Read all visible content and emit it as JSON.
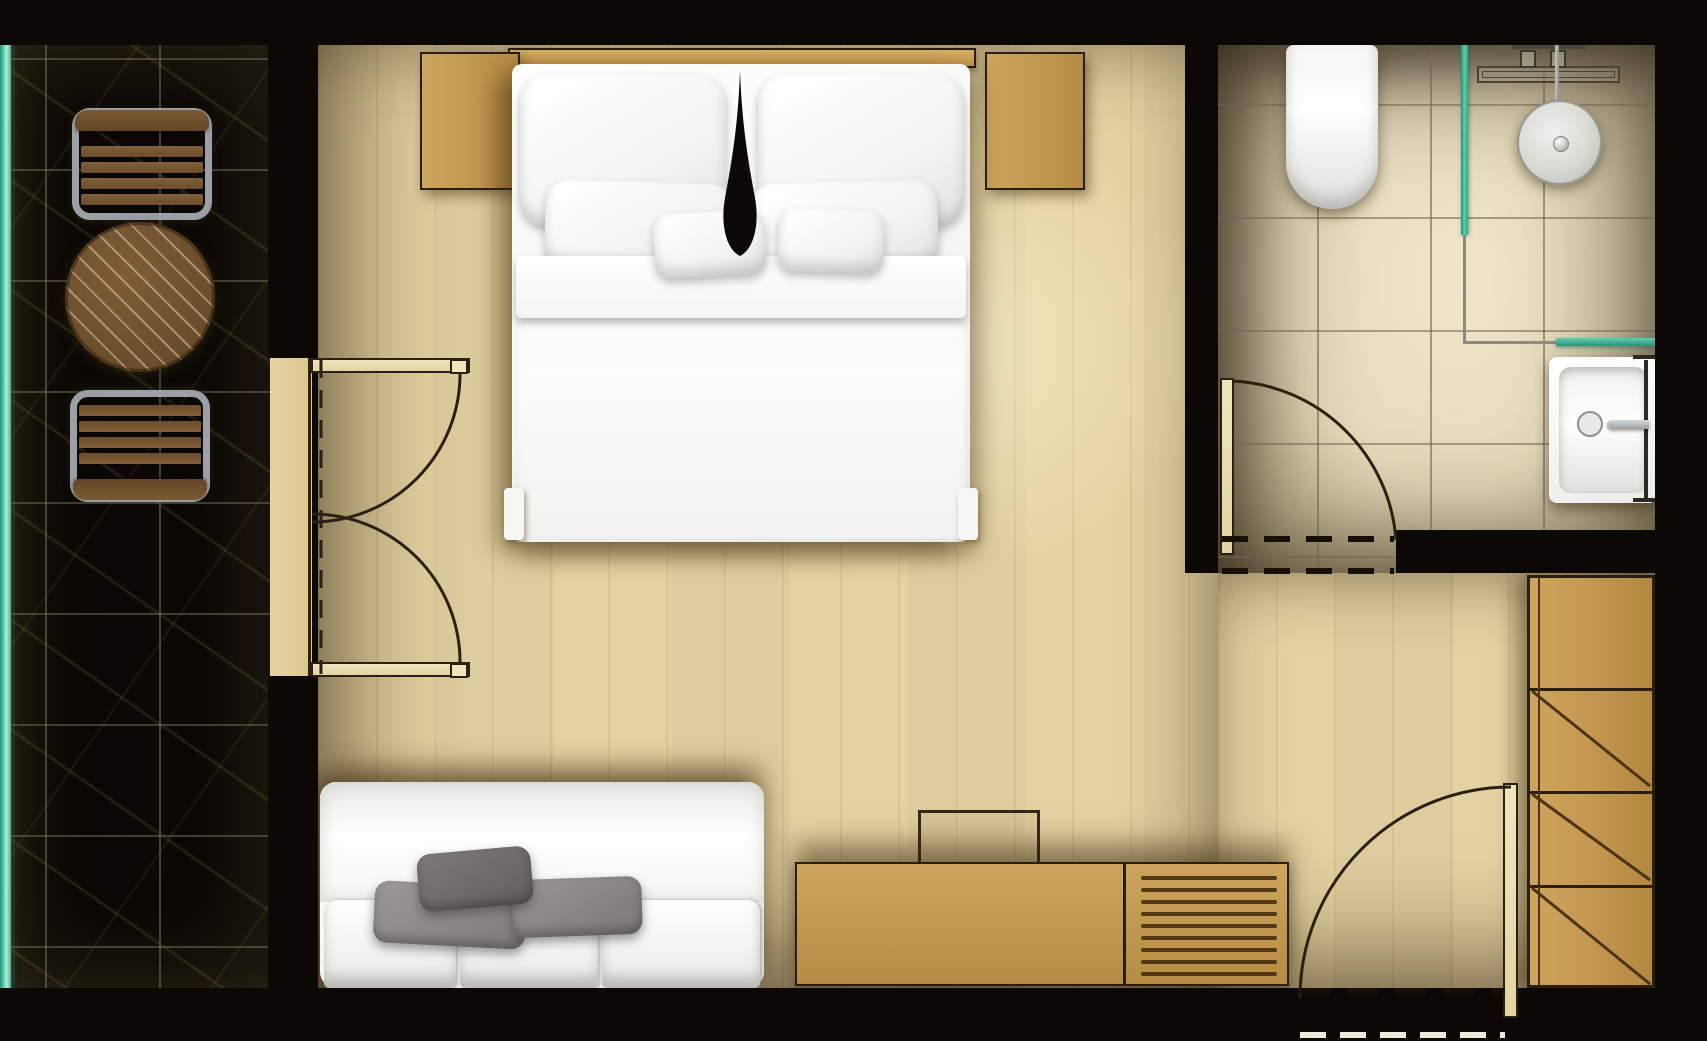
{
  "app": {
    "type": "architectural-floor-plan",
    "view": "top-down-render",
    "title": "hotel-room-floor-plan",
    "visible_text_labels": []
  },
  "colors": {
    "wall": "#0b0805",
    "marble": "#ece1c4",
    "wood_floor": "#e8d8a9",
    "furniture_wood": "#cda55e",
    "furniture_wood_dark": "#b68c44",
    "furniture_outline": "#2a1e0e",
    "dark_wood": "#6f4f2c",
    "metal_gray": "#9aa0a6",
    "glass_teal": "#45c4a4",
    "fixture_white": "#fafaf8",
    "pillow_gray": "#908e8b",
    "pillow_dark_gray": "#6d6b68",
    "line_dark": "#2b2013"
  },
  "rooms": {
    "balcony": {
      "floor": "marble-tile",
      "features": [
        "glass-railing"
      ],
      "furniture": [
        "lounge-chair",
        "round-patio-table",
        "lounge-chair"
      ]
    },
    "bedroom": {
      "floor": "wood-plank",
      "features": [
        "double-french-door-to-balcony"
      ],
      "furniture": [
        "headboard",
        "nightstand-left",
        "nightstand-right",
        "double-bed-with-pillows",
        "sofa-with-cushions",
        "tv",
        "media-console-with-drawers"
      ]
    },
    "bathroom": {
      "floor": "marble-tile",
      "features": [
        "swing-door",
        "glass-shower-partition"
      ],
      "furniture": [
        "toilet",
        "shower-head",
        "shower-valves",
        "linear-drain",
        "glass-shelf",
        "washbasin-with-faucet"
      ]
    },
    "entry": {
      "floor": "wood-plank",
      "features": [
        "entry-swing-door"
      ],
      "furniture": [
        "wardrobe-4-sections"
      ]
    }
  }
}
